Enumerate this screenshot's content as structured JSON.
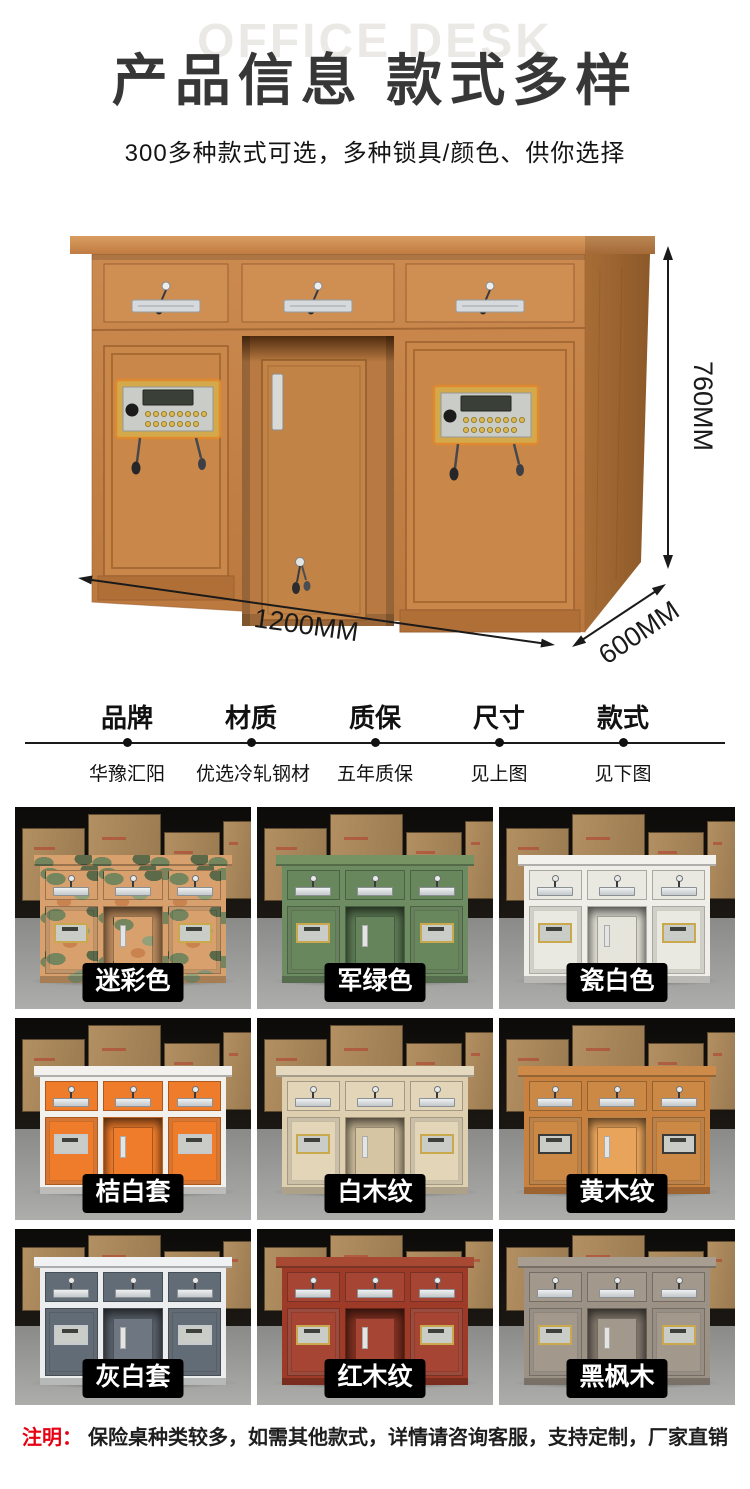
{
  "header": {
    "watermark": "OFFICE DESK",
    "title": "产品信息 款式多样",
    "subtitle": "300多种款式可选，多种锁具/颜色、供你选择"
  },
  "hero": {
    "dimensions": {
      "height_label": "760MM",
      "width_label": "1200MM",
      "depth_label": "600MM"
    }
  },
  "specs": [
    {
      "label": "品牌",
      "value": "华豫汇阳"
    },
    {
      "label": "材质",
      "value": "优选冷轧钢材"
    },
    {
      "label": "质保",
      "value": "五年质保"
    },
    {
      "label": "尺寸",
      "value": "见上图"
    },
    {
      "label": "款式",
      "value": "见下图"
    }
  ],
  "variants": [
    {
      "label": "迷彩色",
      "camo": true,
      "colors": {
        "top": "#d7a06c",
        "frame": "#d7a06c",
        "panel": "#d7a06c",
        "recess": "#b98a5c",
        "inner": "#c99a68",
        "lock": "#c9a84e"
      }
    },
    {
      "label": "军绿色",
      "colors": {
        "top": "#779364",
        "frame": "#6e8c62",
        "panel": "#69875d",
        "recess": "#5c7a54",
        "inner": "#66845c",
        "lock": "#c9a84e"
      }
    },
    {
      "label": "瓷白色",
      "colors": {
        "top": "#f2f1ec",
        "frame": "#efeee8",
        "panel": "#eae9e1",
        "recess": "#dddcd2",
        "inner": "#e6e5dc",
        "lock": "#c9a84e"
      }
    },
    {
      "label": "桔白套",
      "colors": {
        "top": "#f3f1ed",
        "frame": "#f3f1ed",
        "panel": "#ee7c2b",
        "recess": "#ee7c2b",
        "inner": "#ee7c2b",
        "lock": "#c6cacd"
      }
    },
    {
      "label": "白木纹",
      "colors": {
        "top": "#e4d9bf",
        "frame": "#decfb0",
        "panel": "#e2d5b8",
        "recess": "#c7b696",
        "inner": "#d6c5a2",
        "lock": "#c9a84e"
      }
    },
    {
      "label": "黄木纹",
      "colors": {
        "top": "#cd8a48",
        "frame": "#c9813f",
        "panel": "#cc8845",
        "recess": "#e9a45b",
        "inner": "#e9a45b",
        "lock": "#3a3a3a"
      }
    },
    {
      "label": "灰白套",
      "colors": {
        "top": "#eff1f2",
        "frame": "#ebedee",
        "panel": "#626c77",
        "recess": "#596069",
        "inner": "#6d7681",
        "lock": "#c6cacd"
      }
    },
    {
      "label": "红木纹",
      "colors": {
        "top": "#a84a33",
        "frame": "#9d3a28",
        "panel": "#a64534",
        "recess": "#7e2f1f",
        "inner": "#a64534",
        "lock": "#c9a84e"
      }
    },
    {
      "label": "黑枫木",
      "colors": {
        "top": "#a89d91",
        "frame": "#9c9185",
        "panel": "#a3988c",
        "recess": "#80766b",
        "inner": "#a3988c",
        "lock": "#c9a84e"
      }
    }
  ],
  "note": {
    "prefix": "注明：",
    "text": "保险桌种类较多，如需其他款式，详情请咨询客服，支持定制，厂家直销"
  },
  "theme": {
    "title_color": "#373737",
    "note_red": "#e60012",
    "tag_bg": "#000000",
    "tag_text": "#ffffff",
    "wood": "#c5834a",
    "wood_top": "#cd9055",
    "wood_dark": "#9d6332",
    "lock_gold": "#c9a84e",
    "arrow_color": "#1a1a1a"
  }
}
